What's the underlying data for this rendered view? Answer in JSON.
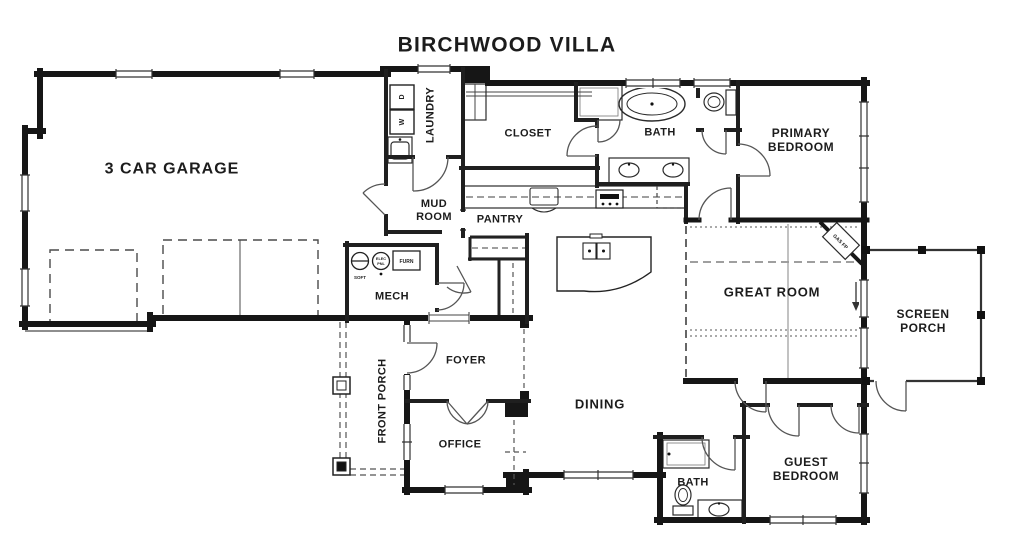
{
  "title": "BIRCHWOOD VILLA",
  "rooms": {
    "garage": "3 CAR GARAGE",
    "laundry": "LAUNDRY",
    "mud_room": "MUD ROOM",
    "pantry": "PANTRY",
    "closet": "CLOSET",
    "primary_bath": "BATH",
    "primary_bedroom": "PRIMARY BEDROOM",
    "mech": "MECH",
    "foyer": "FOYER",
    "front_porch": "FRONT PORCH",
    "office": "OFFICE",
    "dining": "DINING",
    "great_room": "GREAT ROOM",
    "screen_porch": "SCREEN PORCH",
    "guest_bedroom": "GUEST BEDROOM",
    "guest_bath": "BATH"
  },
  "fixtures": {
    "dryer": "D",
    "washer": "W",
    "furnace": "FURN",
    "softener": "SOFT",
    "panel_top": "ELEC",
    "panel_bottom": "PNL",
    "fireplace": "GAS FP"
  },
  "colors": {
    "wall": "#161616",
    "thin_line": "#333333",
    "dashed_line": "#555555",
    "background": "#ffffff"
  }
}
